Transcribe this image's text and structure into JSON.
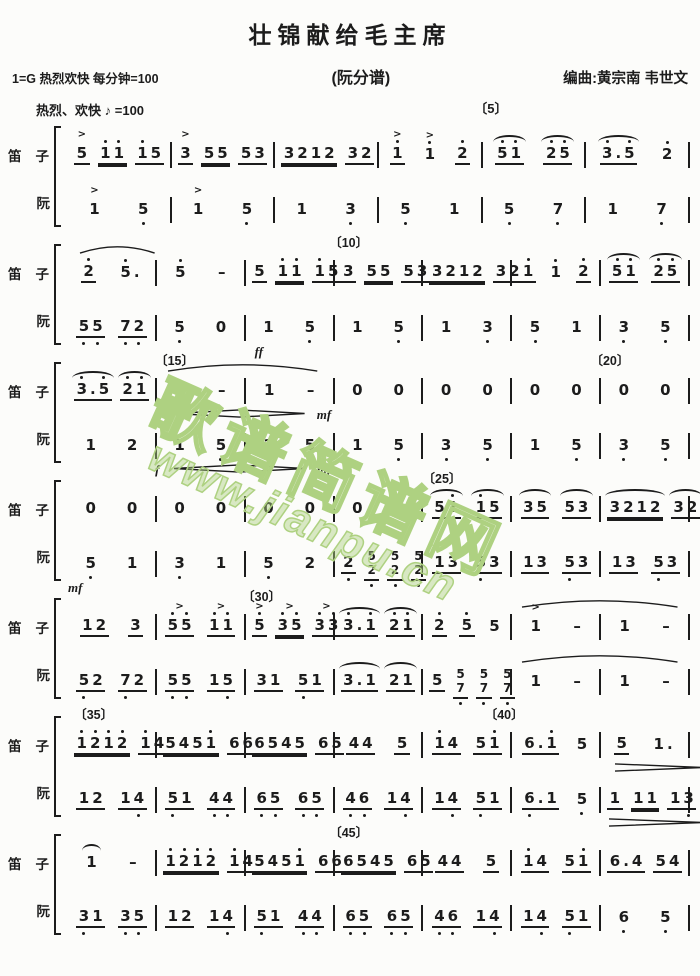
{
  "title": "壮锦献给毛主席",
  "header": {
    "key_tempo": "1=G  热烈欢快 每分钟=100",
    "part_label": "(阮分谱)",
    "composer": "编曲:黄宗南  韦世文",
    "expression": "热烈、欢快",
    "metronome": "♪ =100",
    "first_marker": "〔5〕"
  },
  "watermark": {
    "text": "歌谱简谱网",
    "url": "www.jianpu.cn",
    "color": "#aed181"
  },
  "instruments": {
    "top": "笛子",
    "bottom": "阮"
  },
  "systems": [
    {
      "markers": [],
      "parts": [
        {
          "id": "dizi",
          "measures": [
            ">5_ 1'1'__ 1'5_",
            ">3_ 55__ 53_",
            "3212__ 32_",
            ">1'_ >1' 2'_",
            "~5'1'_ ~2'5'_",
            "~3'.5'_ 2'"
          ],
          "dyn": []
        },
        {
          "id": "ruan",
          "measures": [
            ">1 5,",
            ">1 5,",
            "1 3,",
            "5, 1",
            "5, 7,",
            "1 7,"
          ],
          "dyn": []
        }
      ]
    },
    {
      "markers": [
        {
          "label": "〔10〕",
          "left": "42%"
        }
      ],
      "parts": [
        {
          "id": "dizi",
          "measures": [
            "2'_ 5'.",
            "5' -",
            "5_ 1'1'__ 1'5_",
            "3_ 55__ 53_",
            "3212__ 32_",
            "1'_ 1' 2'_",
            "~5'1'_ ~2'5'_"
          ],
          "dyn": [
            {
              "t": "slur",
              "left": "2%",
              "w": "12%"
            }
          ]
        },
        {
          "id": "ruan",
          "measures": [
            "5,5,_ 7,2,_",
            "5, 0",
            "1 5,",
            "1 5,",
            "1 3,",
            "5, 1",
            "3, 5,"
          ],
          "dyn": [
            {
              "t": "ff",
              "left": "30%"
            }
          ]
        }
      ]
    },
    {
      "markers": [
        {
          "label": "〔15〕",
          "left": "14%"
        },
        {
          "label": "〔20〕",
          "left": "84%"
        }
      ],
      "parts": [
        {
          "id": "dizi",
          "measures": [
            "~3'.5'_ ~2'1'_",
            "1 -",
            "1 -",
            "0 0",
            "0 0",
            "0 0",
            "0 0"
          ],
          "dyn": [
            {
              "t": "slur",
              "left": "16%",
              "w": "24%"
            },
            {
              "t": "f",
              "left": "14%"
            },
            {
              "t": "swell",
              "left": "17%",
              "w": "21%"
            },
            {
              "t": "mf",
              "left": "40%"
            }
          ]
        },
        {
          "id": "ruan",
          "measures": [
            "1 2",
            "1 5,",
            "1 5,",
            "1 5,",
            "3, 5,",
            "1 5,",
            "3, 5,"
          ],
          "dyn": [
            {
              "t": "f",
              "left": "14%"
            },
            {
              "t": "swell",
              "left": "17%",
              "w": "21%"
            },
            {
              "t": "mf",
              "left": "40%"
            }
          ]
        }
      ]
    },
    {
      "markers": [
        {
          "label": "〔25〕",
          "left": "57%"
        }
      ],
      "parts": [
        {
          "id": "dizi",
          "measures": [
            "0 0",
            "0 0",
            "0 0",
            "0 0",
            "~51'_ ~1'5_",
            "~35_ ~53_",
            "~3212__ ~32_"
          ],
          "dyn": []
        },
        {
          "id": "ruan",
          "measures": [
            "5, 1",
            "3, 1",
            "5, 2",
            "2,_ 5/2,_ 5/2,_ 5/2,_",
            "13_ 5,3_",
            "13_ 5,3_",
            "13_ 5,3_"
          ],
          "dyn": [
            {
              "t": "mf",
              "left": "0%"
            }
          ]
        }
      ]
    },
    {
      "markers": [
        {
          "label": "〔30〕",
          "left": "28%"
        }
      ],
      "parts": [
        {
          "id": "dizi",
          "measures": [
            "12_ 3_",
            ">5'5'_ >1'1'_",
            ">5'_ >3'5'__ >3'3'_",
            "~3'.1'_ ~2'1'_",
            "2'_ 5'_ 5",
            ">1 -",
            "1 -"
          ],
          "dyn": [
            {
              "t": "slur",
              "left": "73%",
              "w": "25%"
            }
          ]
        },
        {
          "id": "ruan",
          "measures": [
            "5,2_ 7,2_",
            "5,5,_ 15,_",
            "31_ 5,1_",
            "~3.1_ ~21_",
            "5_ 5/7,_ 5/7,_ 5/7,_",
            "1 -",
            "1 -"
          ],
          "dyn": [
            {
              "t": "slur",
              "left": "73%",
              "w": "25%"
            }
          ]
        }
      ]
    },
    {
      "markers": [
        {
          "label": "〔35〕",
          "left": "1%"
        },
        {
          "label": "〔40〕",
          "left": "67%"
        }
      ],
      "parts": [
        {
          "id": "dizi",
          "measures": [
            "1'2'1'2'__ 1'4_",
            "5451'__ 66_",
            "6545__ 65_",
            "44_ 5_",
            "1'4_ 51'_",
            "6.1'_ 5",
            "5_ 1."
          ],
          "dyn": [
            {
              "t": "dim",
              "left": "88%",
              "w": "14%"
            }
          ]
        },
        {
          "id": "ruan",
          "measures": [
            "12_ 14,_",
            "5,1_ 4,4,_",
            "6,5,_ 6,5,_",
            "4,6,_ 14,_",
            "14,_ 5,1_",
            "6,.1_ 5,",
            "1_ 11__ 13,_"
          ],
          "dyn": [
            {
              "t": "dim",
              "left": "87%",
              "w": "15%"
            }
          ]
        }
      ]
    },
    {
      "markers": [
        {
          "label": "〔45〕",
          "left": "42%"
        }
      ],
      "parts": [
        {
          "id": "dizi",
          "measures": [
            "~1 -",
            "1'2'1'2'__ 1'4_",
            "5451'__ 66_",
            "6545__ 65_",
            "44_ 5_",
            "1'4_ 51'_",
            "6.4_ 54_"
          ],
          "dyn": []
        },
        {
          "id": "ruan",
          "measures": [
            "3,1_ 3,5,_",
            "12_ 14,_",
            "5,1_ 4,4,_",
            "6,5,_ 6,5,_",
            "4,6,_ 14,_",
            "14,_ 5,1_",
            "6, 5,"
          ],
          "dyn": []
        }
      ]
    }
  ]
}
